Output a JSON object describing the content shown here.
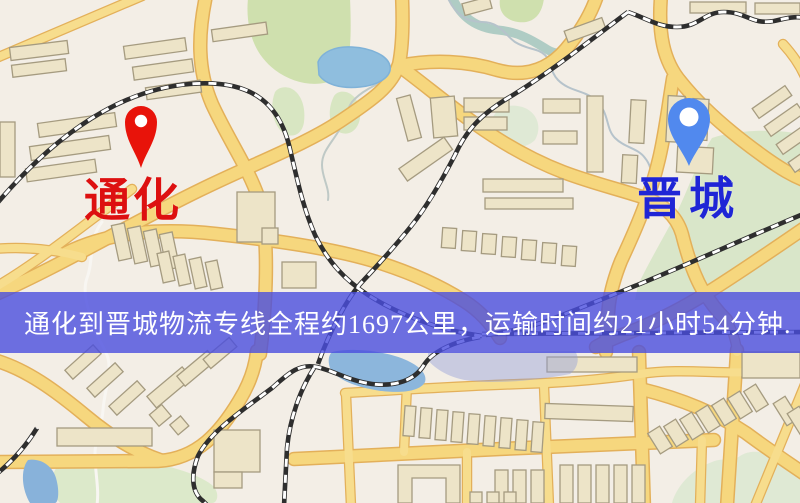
{
  "page": {
    "width": 800,
    "height": 503,
    "type": "logistics-route-map"
  },
  "map": {
    "origin": {
      "name": "通化",
      "label_color": "#dd1010",
      "marker": "red-location-pin",
      "marker_color": "#e8130a"
    },
    "destination": {
      "name": "晋城",
      "label_color": "#1f25d6",
      "marker": "blue-location-pin",
      "marker_color": "#5189ee"
    },
    "banner": {
      "text": "通化到晋城物流专线全程约1697公里，运输时间约21小时54分钟.",
      "background_color": "rgba(74,78,222,0.8)",
      "text_color": "#ffffff",
      "route": {
        "from": "通化",
        "to": "晋城",
        "distance_km": "1697",
        "duration_hours": "21",
        "duration_minutes": "54"
      }
    },
    "palette": {
      "background": "#f3eee6",
      "road_fill": "#f6d77e",
      "road_casing": "#e2aa4e",
      "building_fill": "#ede4c8",
      "building_stroke": "#a59b80",
      "park_green": "#d3e2b4",
      "water_blue": "#8fbede",
      "railway_dark": "#2e2e2e"
    }
  }
}
